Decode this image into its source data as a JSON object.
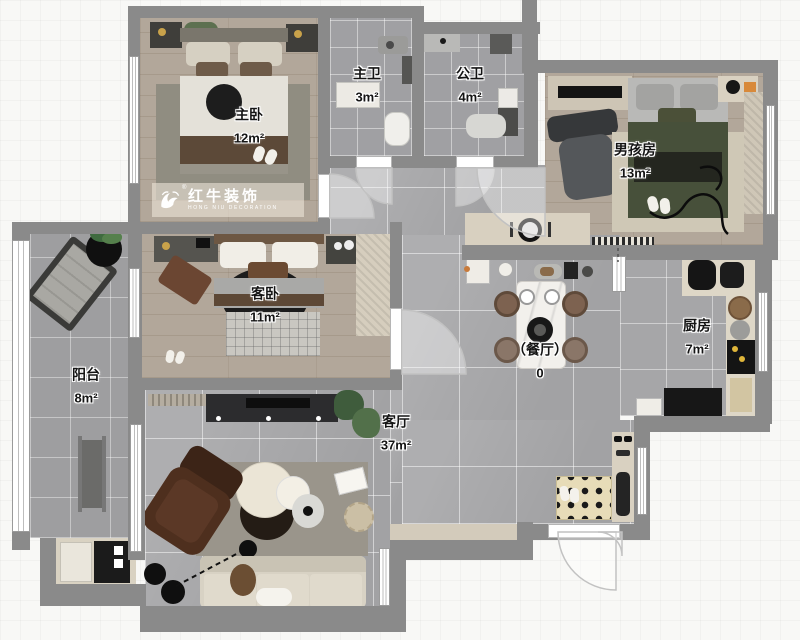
{
  "plan": {
    "watermark": {
      "brand": "红牛装饰",
      "subtitle": "HONG NIU DECORATION",
      "registered": "®"
    },
    "rooms": [
      {
        "id": "master-bedroom",
        "name": "主卧",
        "area": "12m²"
      },
      {
        "id": "master-bath",
        "name": "主卫",
        "area": "3m²"
      },
      {
        "id": "public-bath",
        "name": "公卫",
        "area": "4m²"
      },
      {
        "id": "boys-room",
        "name": "男孩房",
        "area": "13m²"
      },
      {
        "id": "guest-bedroom",
        "name": "客卧",
        "area": "11m²"
      },
      {
        "id": "kitchen",
        "name": "厨房",
        "area": "7m²"
      },
      {
        "id": "balcony",
        "name": "阳台",
        "area": "8m²"
      },
      {
        "id": "dining",
        "name": "（餐厅）",
        "area": "0"
      },
      {
        "id": "living-room",
        "name": "客厅",
        "area": "37m²"
      }
    ],
    "colors": {
      "wall": "#8a8a8a",
      "wood_floor": "#b2a79a",
      "tile_floor": "#a9a9ab",
      "bath_floor": "#a0a0a3",
      "sofa": "#d8d2c4",
      "boys_bed_green": "#47503a",
      "recliner_brown": "#4a2c1b",
      "counter_beige": "#d8d0c0",
      "watermark_text": "#ffffff"
    }
  }
}
